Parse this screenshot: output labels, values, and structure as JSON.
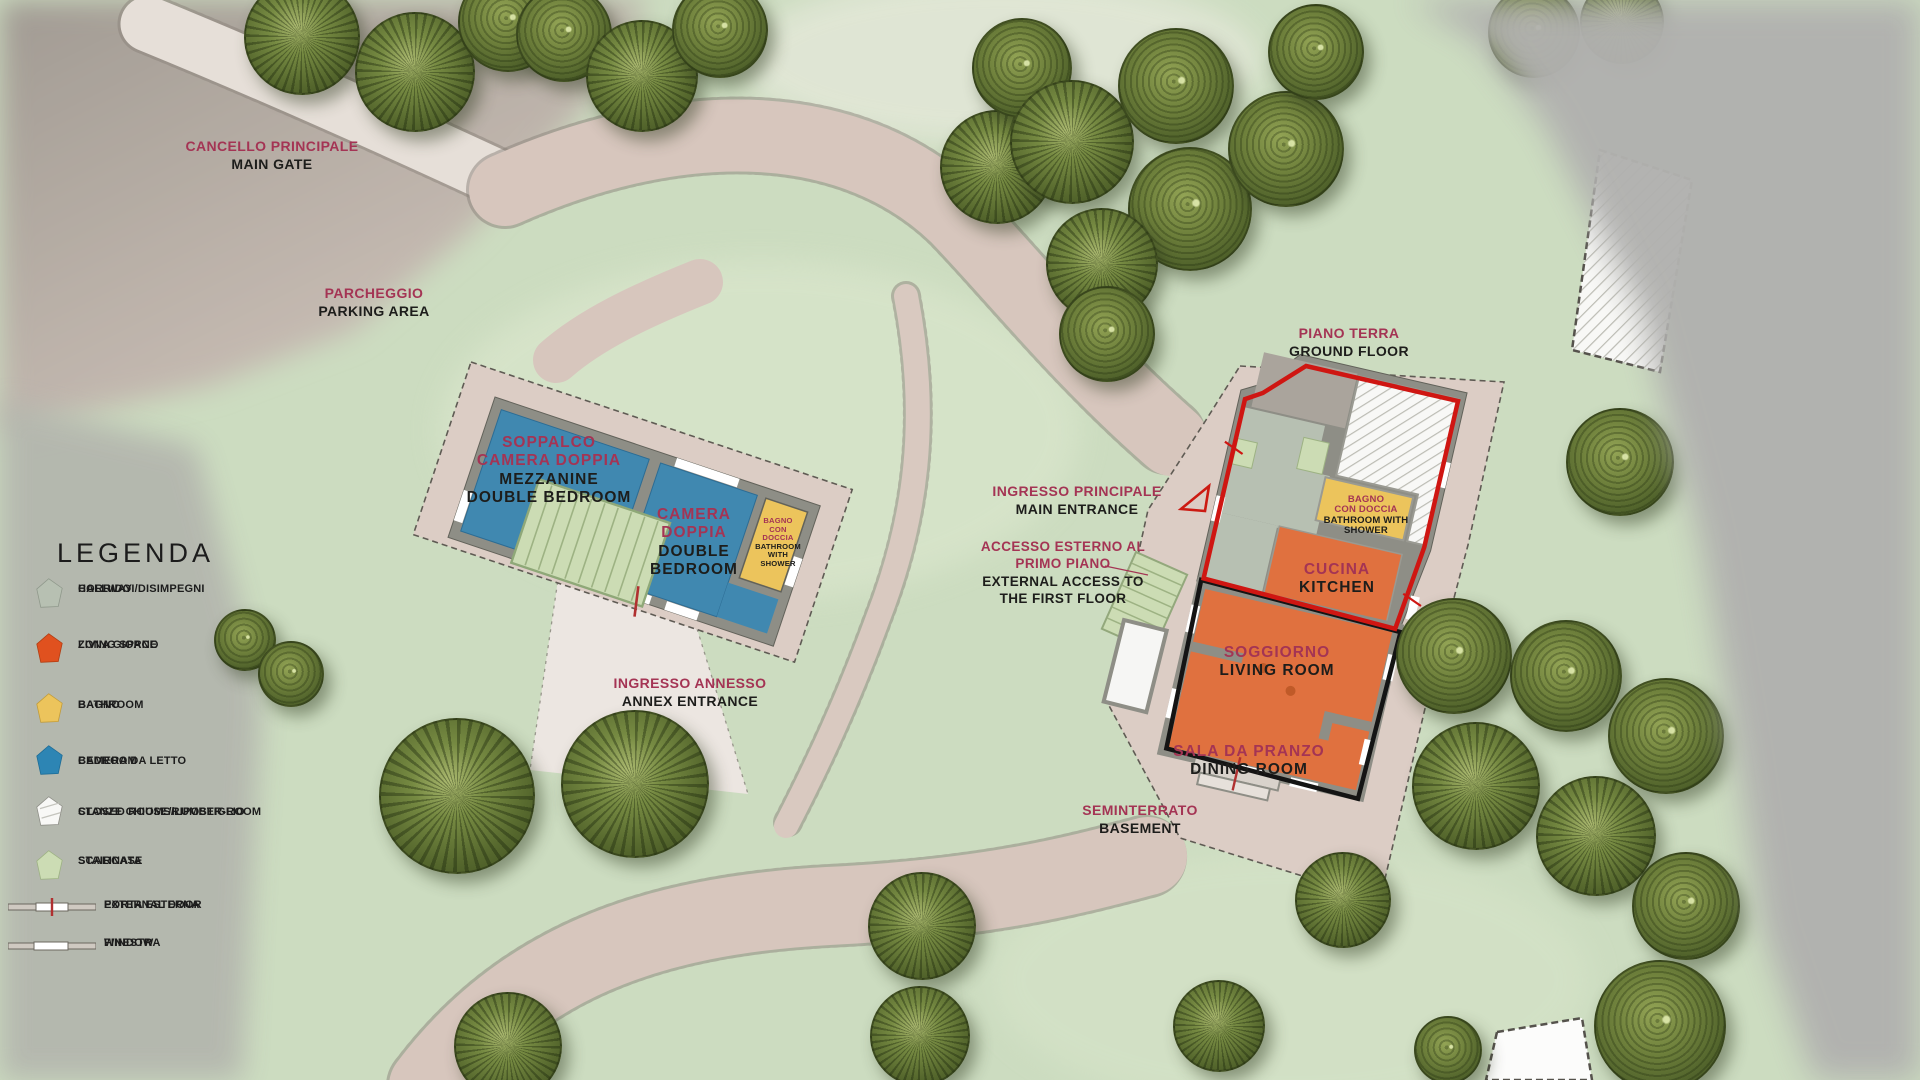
{
  "palette": {
    "grass": "#ccdcc0",
    "path": "#d7c6bd",
    "plot": "#dccdc5",
    "wall": "#8e8e86",
    "bedroom_blue": "#4088b0",
    "living_orange": "#e0713f",
    "bathroom_yellow": "#ecc45c",
    "hallway": "#b7c0b2",
    "staircase": "#ccdcb4",
    "closed_room": "#f8f8f6",
    "ground_floor_outline": "#cf1612",
    "basement_outline": "#141414",
    "label_red": "#a43454",
    "label_black": "#1d1d1b",
    "out_of_bounds_gray": "#b1b1af"
  },
  "legend": {
    "title": "LEGENDA",
    "items": [
      {
        "id": "hallway",
        "it": "CORRIDOI/DISIMPEGNI",
        "en": "HALLWAY",
        "color": "#b7c0b2"
      },
      {
        "id": "living-space",
        "it": "ZONA GIORNO",
        "en": "LIVING SPACE",
        "color": "#e0511f"
      },
      {
        "id": "bathroom",
        "it": "BAGNO",
        "en": "BATHROOM",
        "color": "#ecc45c"
      },
      {
        "id": "bedroom",
        "it": "CAMERA DA LETTO",
        "en": "BEDROOM",
        "color": "#2d85b4"
      },
      {
        "id": "closed-rooms",
        "it": "STANZE CHIUSE/RIPOSTIGLIO",
        "en": "CLOSED ROOMS/LUMBER-ROOM",
        "color": "#f8f8f6"
      },
      {
        "id": "staircase",
        "it": "SCALINATA",
        "en": "STAIRCASE",
        "color": "#ccdcb4"
      },
      {
        "id": "external-door",
        "it": "PORTA ESTERNA",
        "en": "EXTERNAL DOOR",
        "color": "#b03030"
      },
      {
        "id": "window",
        "it": "FINESTRA",
        "en": "WINDOW",
        "color": "#ffffff"
      }
    ]
  },
  "map_labels": {
    "main_gate": {
      "it": "CANCELLO PRINCIPALE",
      "en": "MAIN GATE"
    },
    "parking": {
      "it": "PARCHEGGIO",
      "en": "PARKING AREA"
    },
    "annex_entrance": {
      "it": "INGRESSO ANNESSO",
      "en": "ANNEX ENTRANCE"
    },
    "ground_floor": {
      "it": "PIANO TERRA",
      "en": "GROUND FLOOR"
    },
    "main_entrance": {
      "it": "INGRESSO PRINCIPALE",
      "en": "MAIN ENTRANCE"
    },
    "external_access": {
      "it": [
        "ACCESSO ESTERNO AL",
        "PRIMO PIANO"
      ],
      "en": [
        "EXTERNAL ACCESS TO",
        "THE FIRST FLOOR"
      ]
    },
    "basement": {
      "it": "SEMINTERRATO",
      "en": "BASEMENT"
    }
  },
  "rooms": {
    "mezzanine": {
      "it": [
        "SOPPALCO",
        "CAMERA DOPPIA"
      ],
      "en": [
        "MEZZANINE",
        "DOUBLE BEDROOM"
      ]
    },
    "double_bedroom": {
      "it": [
        "CAMERA",
        "DOPPIA"
      ],
      "en": [
        "DOUBLE",
        "BEDROOM"
      ]
    },
    "annex_bathroom": {
      "it": [
        "BAGNO",
        "CON",
        "DOCCIA"
      ],
      "en": [
        "BATHROOM",
        "WITH",
        "SHOWER"
      ]
    },
    "main_bathroom": {
      "it": [
        "BAGNO",
        "CON DOCCIA"
      ],
      "en": [
        "BATHROOM WITH",
        "SHOWER"
      ]
    },
    "kitchen": {
      "it": "CUCINA",
      "en": "KITCHEN"
    },
    "living_room": {
      "it": "SOGGIORNO",
      "en": "LIVING ROOM"
    },
    "dining_room": {
      "it": "SALA DA PRANZO",
      "en": "DINING ROOM"
    }
  }
}
